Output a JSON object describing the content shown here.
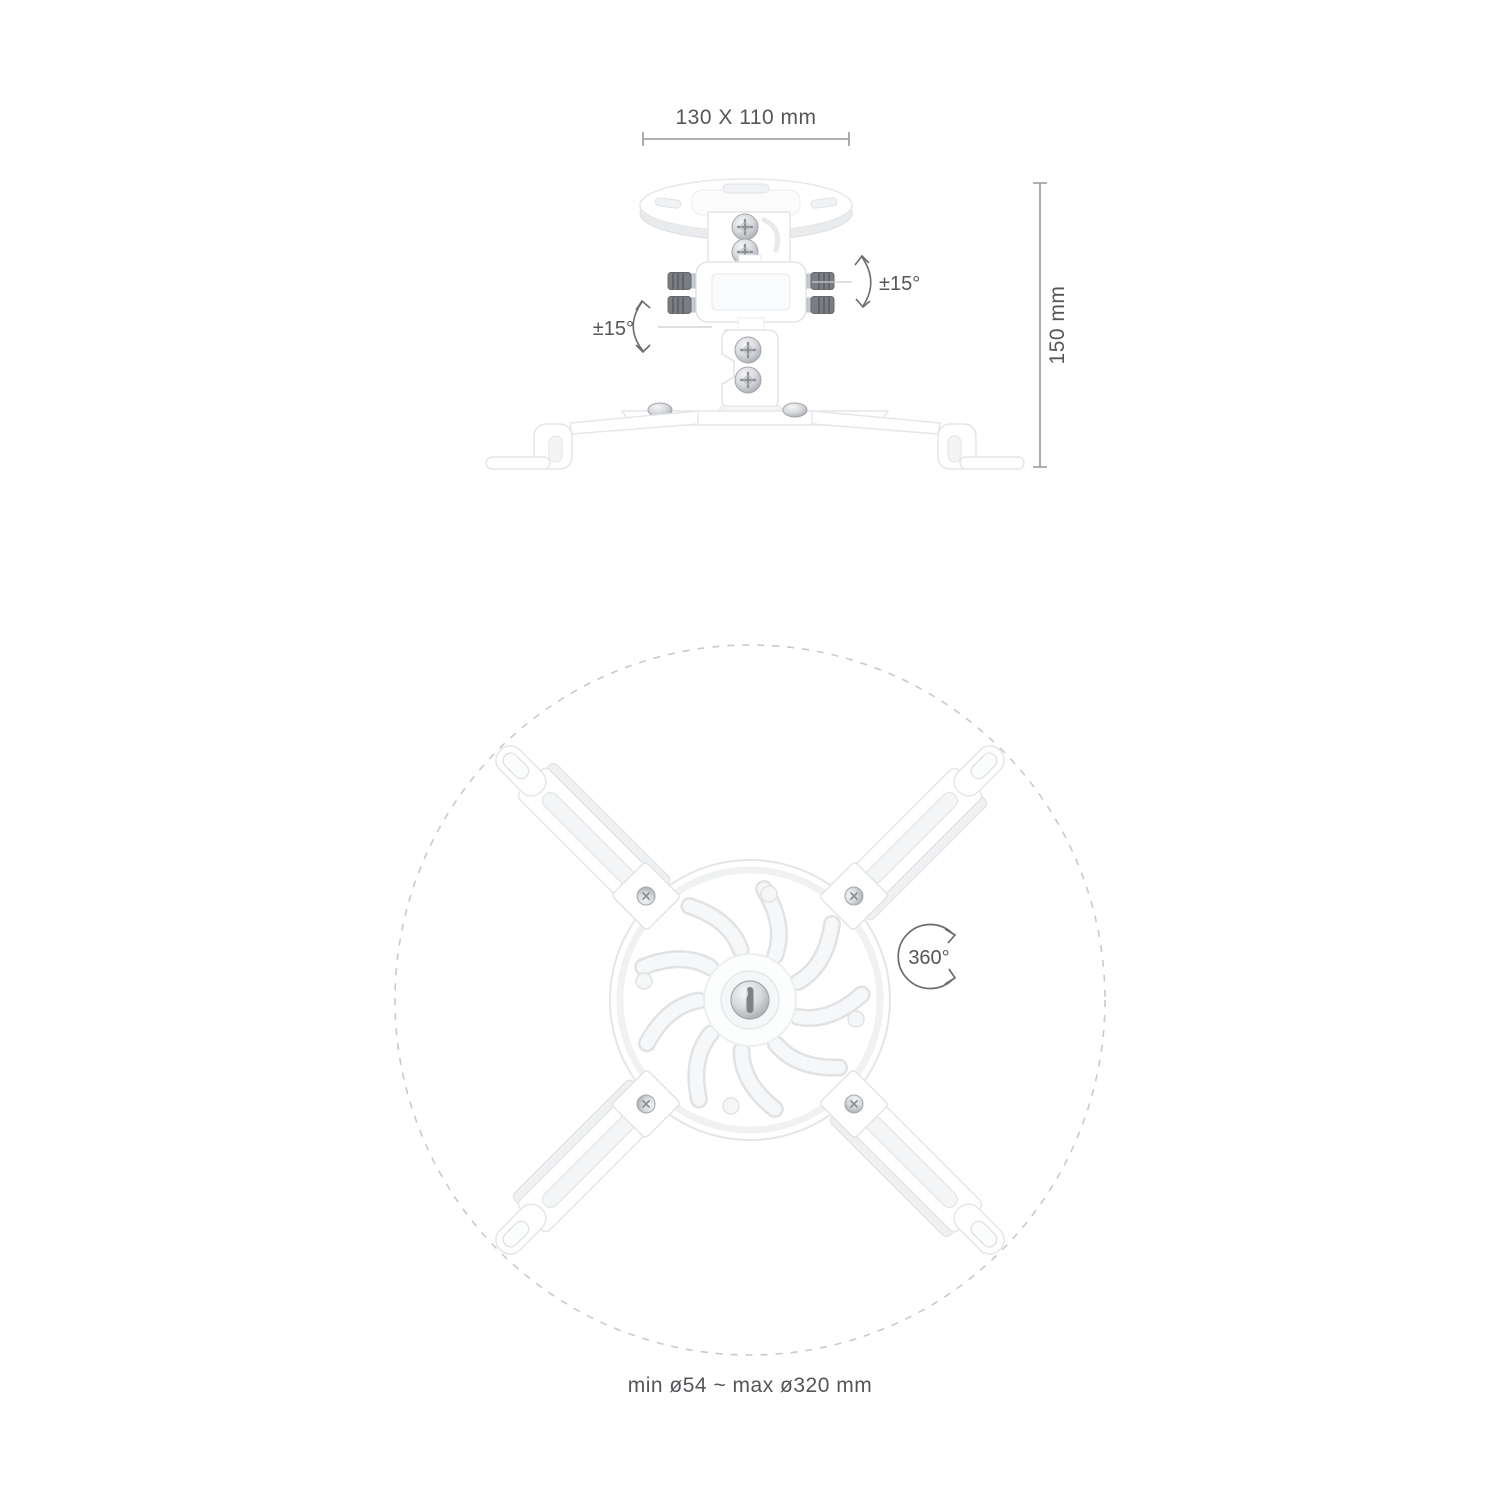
{
  "side_view": {
    "width_label": "130 X 110 mm",
    "height_label": "150 mm",
    "tilt_left_label": "±15°",
    "tilt_right_label": "±15°"
  },
  "top_view": {
    "rotation_label": "360°",
    "diameter_label": "min ø54 ~ max ø320 mm"
  },
  "colors": {
    "background": "#ffffff",
    "label_text": "#55565a",
    "dimension_line": "#97989b",
    "leader_line": "#c9cacc",
    "arc_arrow": "#6b6c6f",
    "dashed_circle": "#c9cacc",
    "product_fill": "#ffffff",
    "product_edge": "#e4e6e8",
    "product_recess": "#f3f4f6",
    "chrome": "#d6d8db",
    "chrome_dark": "#a3a6aa",
    "knob": "#7a7d82"
  }
}
